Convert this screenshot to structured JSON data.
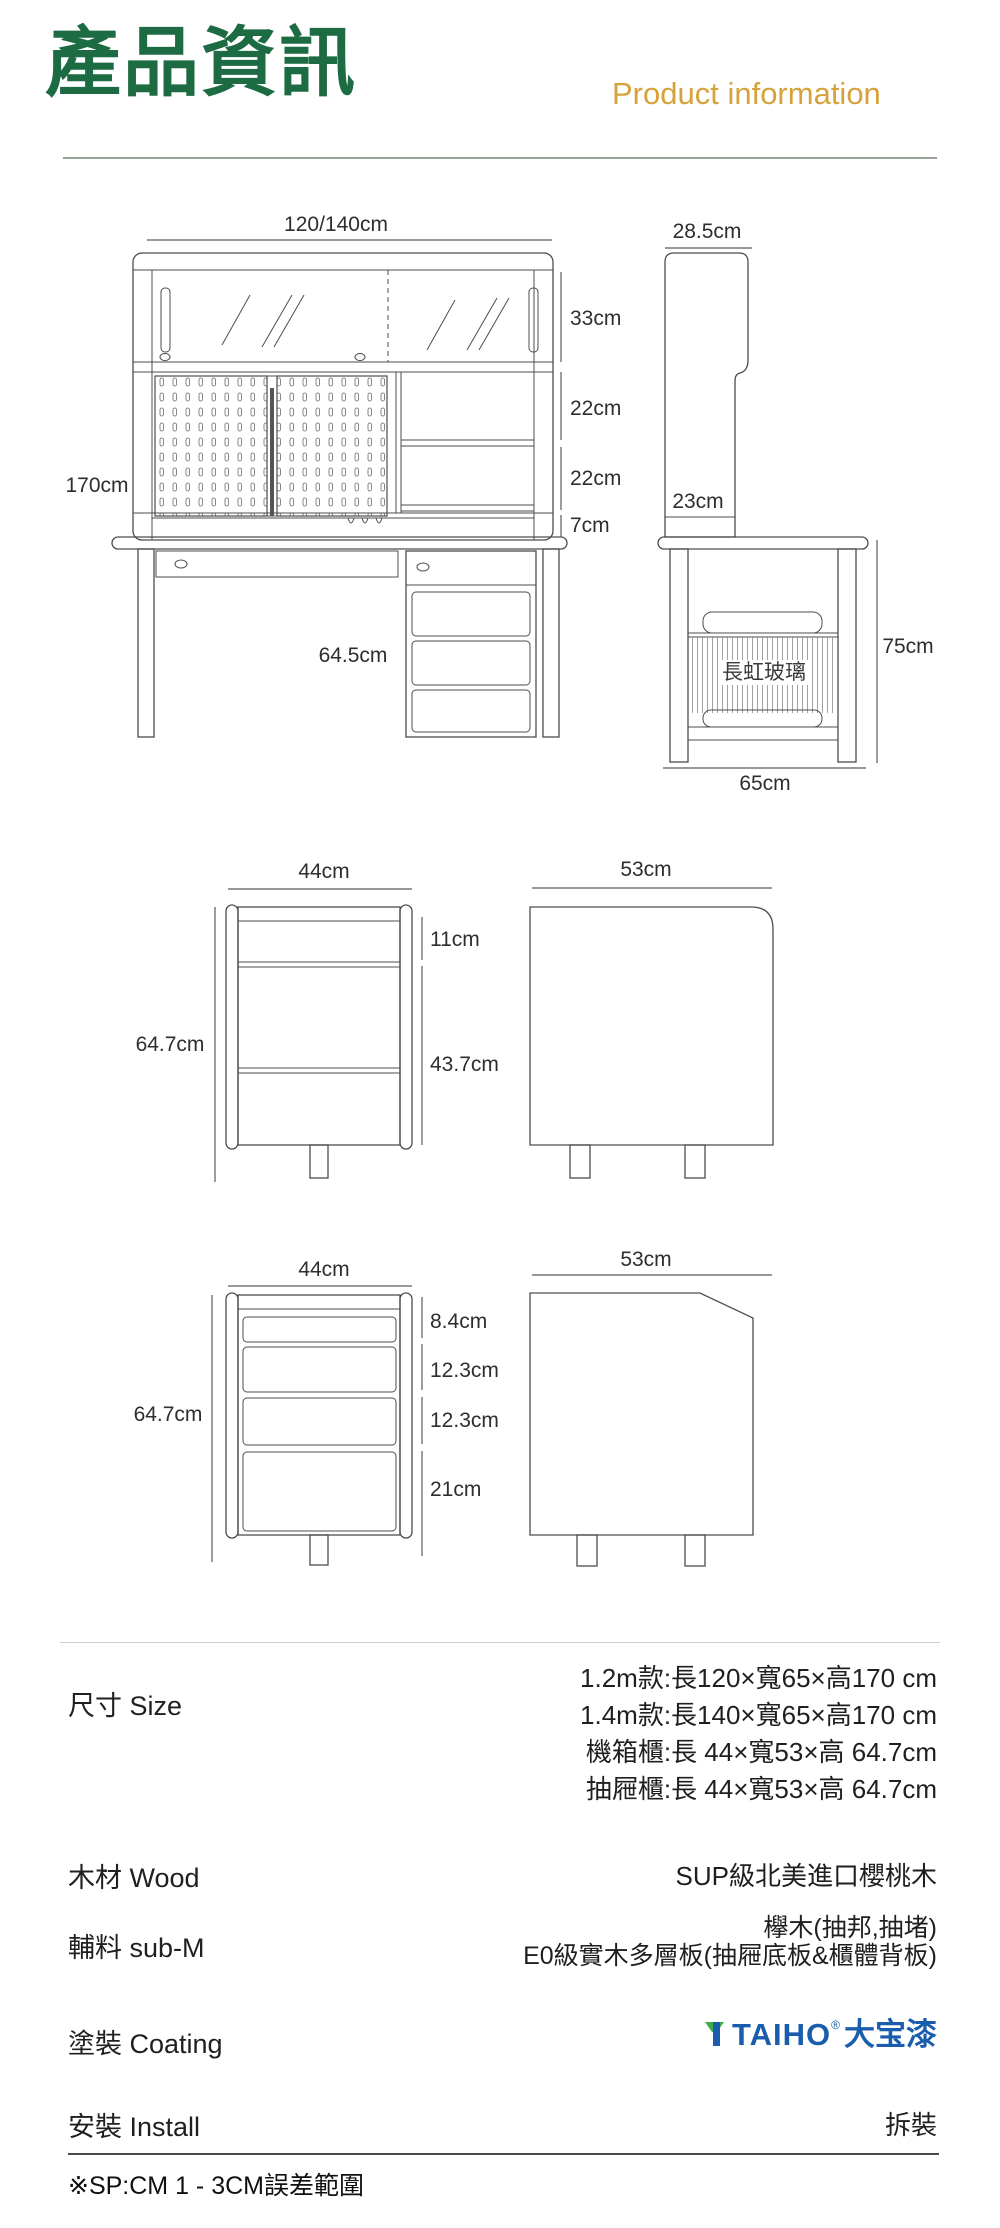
{
  "colors": {
    "title-green": "#1d6b43",
    "subtitle-gold": "#d6a23b",
    "brand-blue": "#1a5dad",
    "brand-green": "#3fae49",
    "line-dark": "#4d4d4d"
  },
  "header": {
    "title": "產品資訊",
    "subtitle": "Product information"
  },
  "desk_front": {
    "width": "120/140cm",
    "height": "170cm",
    "glass_section": "33cm",
    "shelf_a": "22cm",
    "shelf_b": "22cm",
    "rail": "7cm",
    "clearance": "64.5cm"
  },
  "desk_side": {
    "hutch_depth": "28.5cm",
    "lower_depth": "23cm",
    "height": "75cm",
    "depth": "65cm",
    "glass_text": "長虹玻璃"
  },
  "host_cabinet": {
    "front_width": "44cm",
    "top_gap": "11cm",
    "door_height": "43.7cm",
    "height": "64.7cm",
    "side_depth": "53cm"
  },
  "drawer_cabinet": {
    "front_width": "44cm",
    "drawer1": "8.4cm",
    "drawer2": "12.3cm",
    "drawer3": "12.3cm",
    "drawer4": "21cm",
    "height": "64.7cm",
    "side_depth": "53cm"
  },
  "specs": {
    "size": {
      "label": "尺寸 Size",
      "lines": [
        "1.2m款:長120×寬65×高170 cm",
        "1.4m款:長140×寬65×高170 cm",
        "機箱櫃:長 44×寬53×高 64.7cm",
        "抽屜櫃:長 44×寬53×高 64.7cm"
      ]
    },
    "wood": {
      "label": "木材 Wood",
      "value": "SUP級北美進口櫻桃木"
    },
    "sub_material": {
      "label": "輔料 sub-M",
      "lines": [
        "欅木(抽邦,抽堵)",
        "E0級實木多層板(抽屜底板&櫃體背板)"
      ]
    },
    "coating": {
      "label": "塗裝 Coating",
      "brand_name": "TAIHO",
      "brand_reg": "®",
      "brand_cn": "大宝漆"
    },
    "install": {
      "label": "安裝 Install",
      "value": "拆裝"
    },
    "footnote": "※SP:CM 1 - 3CM誤差範圍"
  }
}
